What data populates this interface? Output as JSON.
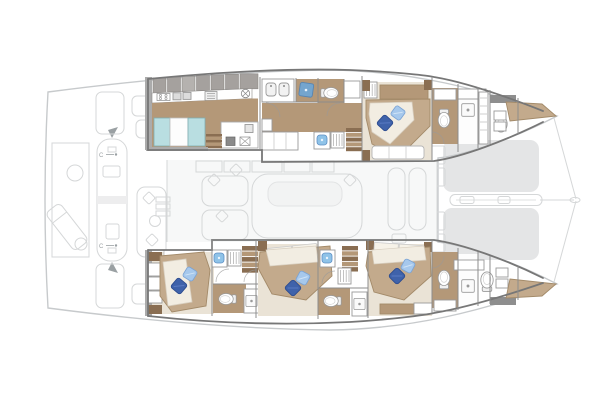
{
  "title": "Catamaran interior deck plan — twin-hull yacht layout, bows to the right",
  "labels": {
    "cleat_fore": "C",
    "cleat_aft": "C"
  },
  "icons": {
    "toilet": "oval-bowl-with-tank",
    "shower": "square-with-drain-dot",
    "sink": "blue-rounded-basin",
    "closet": "rect-with-hanger-lines",
    "stairs": "stacked-wood-treads",
    "stove": "rect-with-burners",
    "extractor-fan": "circle-with-spokes",
    "pillow": "rotated-square-cushion",
    "trampoline": "gray-net-panel",
    "cleat": "C-with-tick"
  },
  "colors": {
    "paper": "#ffffff",
    "outline": "#c7cacc",
    "tramp": "#e4e5e6",
    "faded": "#d5d7d8",
    "faded_fill": "#f6f7f7",
    "salon_fill": "#e9eaeb",
    "slat": "#dcdddd",
    "label": "#9aa0a3",
    "wall": "#777777",
    "wall_light": "#ababab",
    "divider": "#8d8d8d",
    "cabinet": "#a5a19e",
    "counter_edge": "#8c8986",
    "wood": "#b49878",
    "wood_dark": "#8a6e52",
    "cream": "#eae3d6",
    "mattress": "#f2ede2",
    "bed_tan": "#c3aa8c",
    "bed_edge": "#a38a69",
    "teal": "#b9dee1",
    "teal_edge": "#7faeb3",
    "glass_blue": "#6ea7d8",
    "sink_blue": "#8fc3e8",
    "sink_edge": "#5d8fc4",
    "pillow_dark": "#3f62aa",
    "pillow_dark_edge": "#2b4a8d",
    "pillow_light": "#a6c8ec",
    "pillow_light_edge": "#7ba3d4",
    "fixture": "#9a9a9a"
  }
}
